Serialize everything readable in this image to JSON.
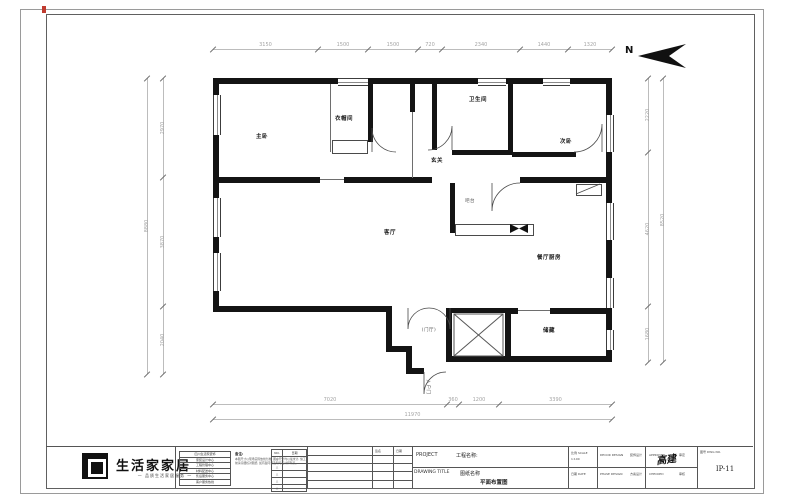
{
  "colors": {
    "wall": "#141414",
    "dim_line": "#bcbcbc",
    "dim_text": "#a4a4a4",
    "red_mark": "#c03b2f"
  },
  "north": {
    "label": "N"
  },
  "plan": {
    "rooms": [
      {
        "name": "master-bedroom",
        "label": "主卧",
        "x": 262,
        "y": 136
      },
      {
        "name": "cloakroom",
        "label": "衣帽间",
        "x": 344,
        "y": 118
      },
      {
        "name": "bathroom",
        "label": "卫生间",
        "x": 478,
        "y": 99
      },
      {
        "name": "second-bedroom",
        "label": "次卧",
        "x": 566,
        "y": 141
      },
      {
        "name": "foyer",
        "label": "玄关",
        "x": 437,
        "y": 160
      },
      {
        "name": "bar-counter",
        "label": "吧台",
        "x": 470,
        "y": 201,
        "small": true
      },
      {
        "name": "living-room",
        "label": "客厅",
        "x": 390,
        "y": 232
      },
      {
        "name": "dining-kitchen",
        "label": "餐厅厨房",
        "x": 549,
        "y": 257
      },
      {
        "name": "entry-hall",
        "label": "(门厅)",
        "x": 429,
        "y": 330,
        "small": true
      },
      {
        "name": "storage",
        "label": "储藏",
        "x": 549,
        "y": 330
      },
      {
        "name": "entry-door",
        "label": "入户门",
        "x": 428,
        "y": 387,
        "rotate": 90,
        "small": true
      }
    ],
    "dims": [
      {
        "name": "dim-top",
        "orient": "h",
        "pos": 49,
        "from": 213,
        "to": 612,
        "ticks": [
          213,
          318,
          368,
          418,
          442,
          520,
          568,
          612
        ],
        "labels": [
          "3150",
          "1500",
          "1500",
          "720",
          "2340",
          "1440",
          "1320"
        ]
      },
      {
        "name": "dim-bottom",
        "orient": "h",
        "pos": 404,
        "from": 213,
        "to": 612,
        "ticks": [
          213,
          447,
          459,
          499,
          612
        ],
        "labels": [
          "7020",
          "360",
          "1200",
          "3390"
        ]
      },
      {
        "name": "dim-bottom-total",
        "orient": "h",
        "pos": 419,
        "from": 213,
        "to": 612,
        "ticks": [
          213,
          612
        ],
        "labels": [
          "11970"
        ]
      },
      {
        "name": "dim-left",
        "orient": "v",
        "pos": 163,
        "from": 78,
        "to": 374,
        "ticks": [
          78,
          177,
          306,
          374
        ],
        "labels": [
          "2970",
          "3870",
          "2040"
        ]
      },
      {
        "name": "dim-left-total",
        "orient": "v",
        "pos": 147,
        "from": 78,
        "to": 374,
        "ticks": [
          78,
          374
        ],
        "labels": [
          "8880"
        ]
      },
      {
        "name": "dim-right",
        "orient": "v",
        "pos": 648,
        "from": 78,
        "to": 362,
        "ticks": [
          78,
          152,
          306,
          362
        ],
        "labels": [
          "2220",
          "4620",
          "1680"
        ]
      },
      {
        "name": "dim-right-total",
        "orient": "v",
        "pos": 663,
        "from": 78,
        "to": 362,
        "ticks": [
          78,
          362
        ],
        "labels": [
          "8520"
        ]
      }
    ]
  },
  "title_block": {
    "logo": {
      "name": "生活家家居",
      "tagline": "— 品质生活家居服务 —"
    },
    "info_rows": [
      "四川生活家装饰",
      "家装设计中心",
      "工程管理中心",
      "材料配送中心",
      "售后服务中心",
      "客户服务热线"
    ],
    "notes": {
      "title": "备注:",
      "body": "本图尺寸以现场实际放线为准, 图中尺寸均以毫米计, 施工前请仔细核对图纸, 如有疑问请及时与设计师联系。"
    },
    "revisions": {
      "headers": [
        "NO.",
        "日期"
      ],
      "rows": [
        "△",
        "△",
        "△",
        "△",
        "△"
      ]
    },
    "sign_table": {
      "headers": [
        "签名",
        "日期"
      ]
    },
    "project": {
      "en": "PROJECT",
      "zh": "工程名称:"
    },
    "drawing": {
      "en": "DRAWING TITLE",
      "zh": "图纸名称",
      "title": "平面布置图"
    },
    "cells": {
      "scale_label": "比例 SCALE",
      "scale_value": "1:100",
      "date_label": "日期 DATE",
      "design_en": "DECOR DESIGN",
      "design_zh": "装饰设计",
      "phase_en": "PHASE DESIGN",
      "phase_zh": "方案设计",
      "approved_en": "APPROVED",
      "approved_zh": "审定",
      "checked_en": "CHECKED",
      "checked_zh": "审核",
      "signature": "高建",
      "no_label": "图号 DWG NO.",
      "no_value": "IP-11"
    }
  }
}
